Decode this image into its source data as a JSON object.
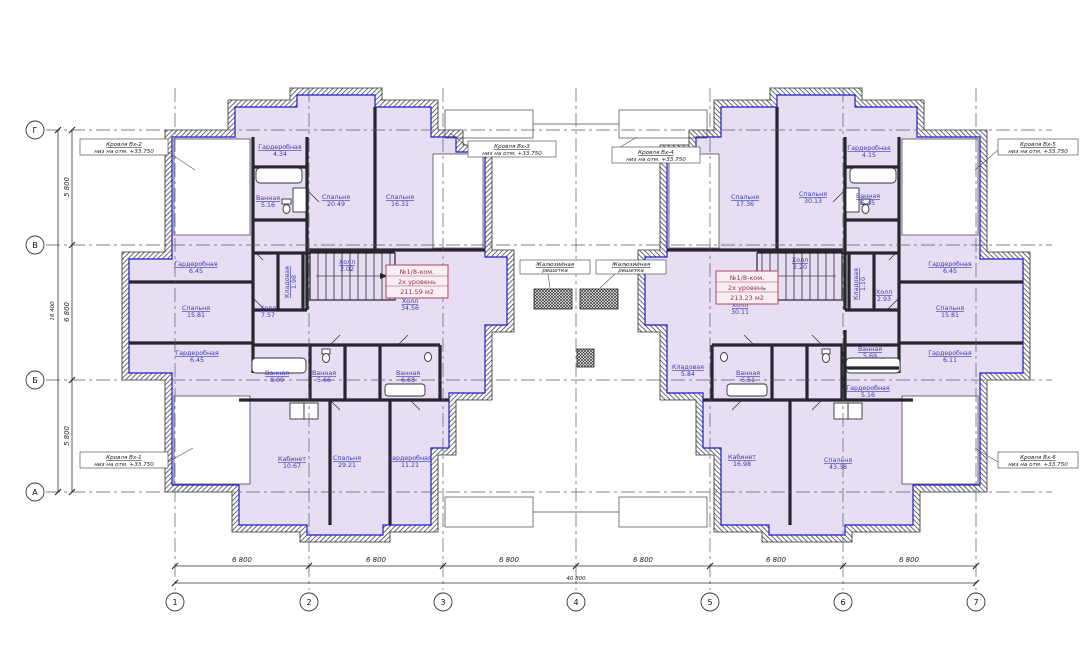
{
  "meta": {
    "accent_blue": "#1d1dcb",
    "room_fill": "#e7def4",
    "label_color": "#3b3bb0",
    "tag_color": "#9c3346"
  },
  "grid": {
    "row_labels": [
      "Г",
      "В",
      "Б",
      "А"
    ],
    "col_labels": [
      "1",
      "2",
      "3",
      "4",
      "5",
      "6",
      "7"
    ],
    "bay_width": "6 800",
    "total_width": "40 800",
    "left_dims": [
      "5 800",
      "6 800",
      "5 800"
    ],
    "total_height": "18 400"
  },
  "apartment_left": {
    "number": "№1/8-ком.",
    "level": "2х уровень",
    "area": "211.59 м2"
  },
  "apartment_right": {
    "number": "№1/8-ком.",
    "level": "2х уровень",
    "area": "213.23 м2"
  },
  "rooms_left": [
    {
      "name": "Гардеробная",
      "area": "4.34"
    },
    {
      "name": "Ванная",
      "area": "5.16"
    },
    {
      "name": "Спальня",
      "area": "20.49"
    },
    {
      "name": "Спальня",
      "area": "16.31"
    },
    {
      "name": "Гардеробная",
      "area": "6.45"
    },
    {
      "name": "Спальня",
      "area": "15.81"
    },
    {
      "name": "Гардеробная",
      "area": "6.45"
    },
    {
      "name": "Кладовая",
      "area": "1.98"
    },
    {
      "name": "Холл",
      "area": "7.57"
    },
    {
      "name": "Холл",
      "area": "2.02"
    },
    {
      "name": "Холл",
      "area": "34.56"
    },
    {
      "name": "Ванная",
      "area": "8.09"
    },
    {
      "name": "Ванная",
      "area": "5.66"
    },
    {
      "name": "Ванная",
      "area": "6.68"
    },
    {
      "name": "Кабинет",
      "area": "10.67"
    },
    {
      "name": "Спальня",
      "area": "29.21"
    },
    {
      "name": "Гардеробная",
      "area": "11.21"
    }
  ],
  "rooms_right": [
    {
      "name": "Спальня",
      "area": "17.36"
    },
    {
      "name": "Спальня",
      "area": "30.13"
    },
    {
      "name": "Гардеробная",
      "area": "4.15"
    },
    {
      "name": "Ванная",
      "area": "5.45"
    },
    {
      "name": "Холл",
      "area": "2.20"
    },
    {
      "name": "Кладовая",
      "area": "1.10"
    },
    {
      "name": "Холл",
      "area": "2.93"
    },
    {
      "name": "Гардеробная",
      "area": "6.45"
    },
    {
      "name": "Спальня",
      "area": "15.81"
    },
    {
      "name": "Гардеробная",
      "area": "6.11"
    },
    {
      "name": "Кладовая",
      "area": "5.84"
    },
    {
      "name": "Ванная",
      "area": "6.51"
    },
    {
      "name": "Ванная",
      "area": "5.69"
    },
    {
      "name": "Гардеробная",
      "area": "5.16"
    },
    {
      "name": "Кабинет",
      "area": "16.98"
    },
    {
      "name": "Спальня",
      "area": "43.38"
    },
    {
      "name": "Холл",
      "area": "30.11"
    }
  ],
  "callouts": {
    "tl": {
      "title": "Кровля Вх-2",
      "note": "низ на отм. +33.750"
    },
    "tm1": {
      "title": "Кровля Вх-3",
      "note": "низ на отм. +33.750"
    },
    "tm2": {
      "title": "Кровля Вх-4",
      "note": "низ на отм. +33.750"
    },
    "tr": {
      "title": "Кровля Вх-5",
      "note": "низ на отм. +33.750"
    },
    "bl": {
      "title": "Кровля Вх-1",
      "note": "низ на отм. +33.750"
    },
    "br": {
      "title": "Кровля Вх-6",
      "note": "низ на отм. +33.750"
    },
    "shaft": {
      "line1": "Жалюзийная",
      "line2": "решетка"
    }
  }
}
